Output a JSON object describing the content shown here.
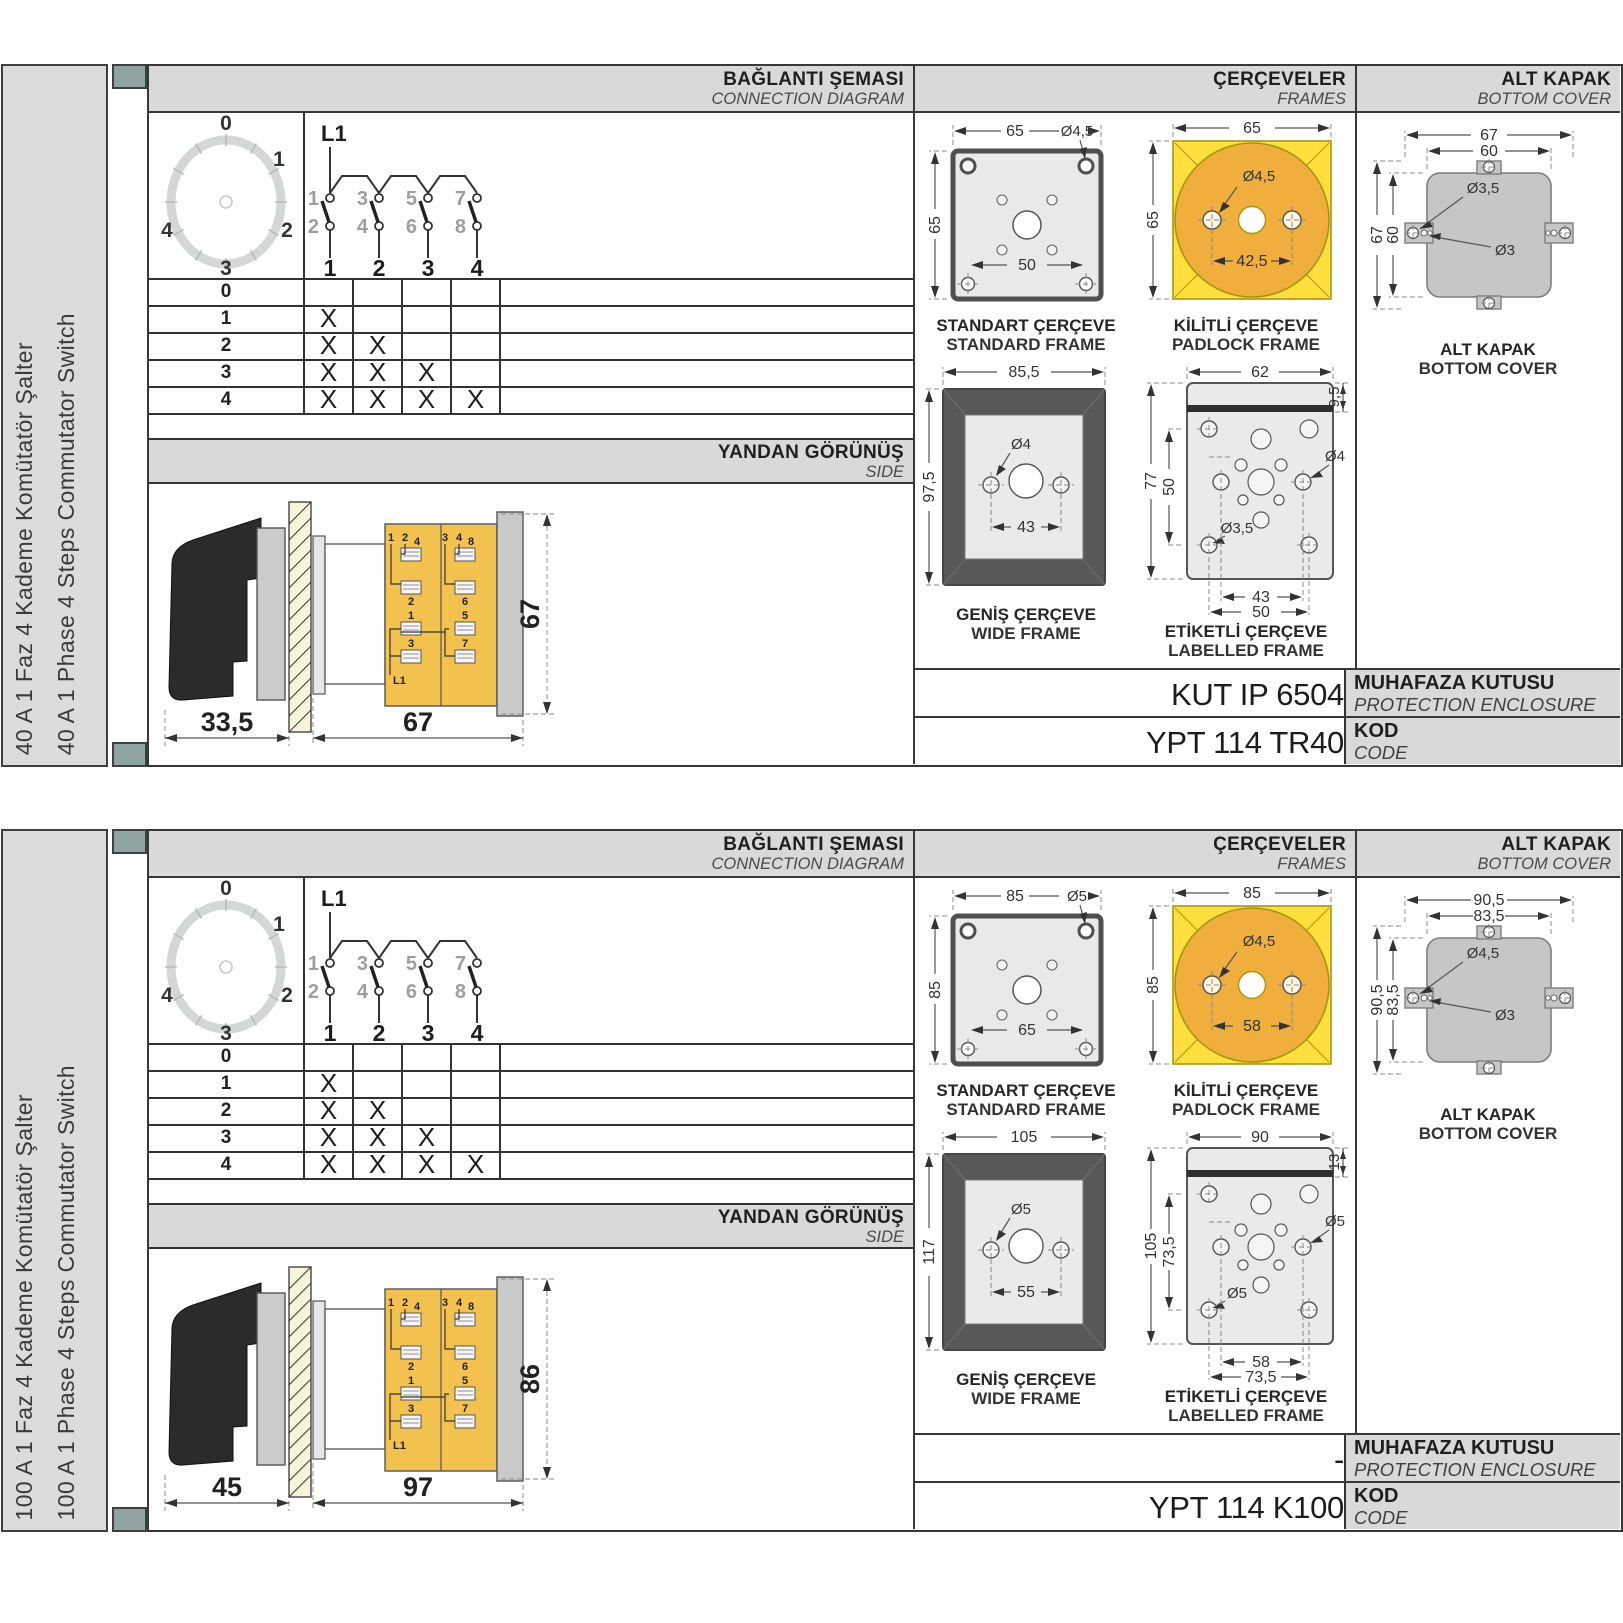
{
  "colors": {
    "header_bg": "#d9d9d9",
    "sidebar_bg": "#dcdcdc",
    "spine_square": "#8fa3a1",
    "frame_line": "#383838",
    "padlock_yellow": "#ffdf3e",
    "padlock_orange": "#f0ae3c",
    "switch_body_yellow": "#f2c14e",
    "wide_frame_gray": "#585858",
    "cover_gray": "#c6c6c6"
  },
  "sections": [
    {
      "sidebar": {
        "title_tr": "40 A 1 Faz 4 Kademe Komütatör Şalter",
        "title_en": "40 A 1 Phase 4 Steps Commutator Switch"
      },
      "headers": {
        "connection_tr": "BAĞLANTI ŞEMASI",
        "connection_en": "CONNECTION DIAGRAM",
        "frames_tr": "ÇERÇEVELER",
        "frames_en": "FRAMES",
        "cover_tr": "ALT KAPAK",
        "cover_en": "BOTTOM COVER"
      },
      "dial": {
        "positions": [
          "0",
          "1",
          "2",
          "3",
          "4"
        ]
      },
      "circuit": {
        "line": "L1",
        "top": [
          "1",
          "3",
          "5",
          "7"
        ],
        "bottom": [
          "2",
          "4",
          "6",
          "8"
        ],
        "outputs": [
          "1",
          "2",
          "3",
          "4"
        ]
      },
      "table": {
        "rows": [
          {
            "pos": "0",
            "marks": [
              "",
              "",
              "",
              ""
            ]
          },
          {
            "pos": "1",
            "marks": [
              "X",
              "",
              "",
              ""
            ]
          },
          {
            "pos": "2",
            "marks": [
              "X",
              "X",
              "",
              ""
            ]
          },
          {
            "pos": "3",
            "marks": [
              "X",
              "X",
              "X",
              ""
            ]
          },
          {
            "pos": "4",
            "marks": [
              "X",
              "X",
              "X",
              "X"
            ]
          }
        ]
      },
      "side": {
        "title_tr": "YANDAN GÖRÜNÜŞ",
        "title_en": "SIDE",
        "dim_handle": "33,5",
        "dim_depth": "67",
        "dim_height": "67",
        "terminals": {
          "pair_left": [
            "1",
            "2"
          ],
          "pair_right": [
            "3",
            "4"
          ],
          "left": [
            "4",
            "2",
            "1",
            "3"
          ],
          "right": [
            "8",
            "6",
            "5",
            "7"
          ],
          "line": "L1"
        }
      },
      "frames": {
        "standard": {
          "title_tr": "STANDART ÇERÇEVE",
          "title_en": "STANDARD FRAME",
          "dim_w": "65",
          "dim_h": "65",
          "dim_hole": "Ø4,5",
          "dim_pitch": "50"
        },
        "padlock": {
          "title_tr": "KİLİTLİ ÇERÇEVE",
          "title_en": "PADLOCK FRAME",
          "dim_w": "65",
          "dim_h": "65",
          "dim_hole": "Ø4,5",
          "dim_pitch": "42,5"
        },
        "wide": {
          "title_tr": "GENİŞ ÇERÇEVE",
          "title_en": "WIDE FRAME",
          "dim_w": "85,5",
          "dim_h": "97,5",
          "dim_hole": "Ø4",
          "dim_pitch": "43"
        },
        "labelled": {
          "title_tr": "ETİKETLİ ÇERÇEVE",
          "title_en": "LABELLED FRAME",
          "dim_w": "62",
          "dim_top": "9,5",
          "dim_h": "77",
          "dim_inner_h": "50",
          "dim_hole_r": "Ø4",
          "dim_hole_l": "Ø3,5",
          "dim_pitch1": "43",
          "dim_pitch2": "50"
        }
      },
      "cover": {
        "caption_tr": "ALT KAPAK",
        "caption_en": "BOTTOM COVER",
        "dim_w_outer": "67",
        "dim_w_inner": "60",
        "dim_h_outer": "67",
        "dim_h_inner": "60",
        "dim_hole1": "Ø3,5",
        "dim_hole2": "Ø3"
      },
      "codes": {
        "enclosure_value": "KUT IP 6504",
        "enclosure_label_tr": "MUHAFAZA KUTUSU",
        "enclosure_label_en": "PROTECTION ENCLOSURE",
        "code_value": "YPT 114 TR40",
        "code_label_tr": "KOD",
        "code_label_en": "CODE"
      }
    },
    {
      "sidebar": {
        "title_tr": "100 A 1 Faz 4 Kademe Komütatör Şalter",
        "title_en": "100 A 1 Phase 4 Steps Commutator Switch"
      },
      "headers": {
        "connection_tr": "BAĞLANTI ŞEMASI",
        "connection_en": "CONNECTION DIAGRAM",
        "frames_tr": "ÇERÇEVELER",
        "frames_en": "FRAMES",
        "cover_tr": "ALT KAPAK",
        "cover_en": "BOTTOM COVER"
      },
      "dial": {
        "positions": [
          "0",
          "1",
          "2",
          "3",
          "4"
        ]
      },
      "circuit": {
        "line": "L1",
        "top": [
          "1",
          "3",
          "5",
          "7"
        ],
        "bottom": [
          "2",
          "4",
          "6",
          "8"
        ],
        "outputs": [
          "1",
          "2",
          "3",
          "4"
        ]
      },
      "table": {
        "rows": [
          {
            "pos": "0",
            "marks": [
              "",
              "",
              "",
              ""
            ]
          },
          {
            "pos": "1",
            "marks": [
              "X",
              "",
              "",
              ""
            ]
          },
          {
            "pos": "2",
            "marks": [
              "X",
              "X",
              "",
              ""
            ]
          },
          {
            "pos": "3",
            "marks": [
              "X",
              "X",
              "X",
              ""
            ]
          },
          {
            "pos": "4",
            "marks": [
              "X",
              "X",
              "X",
              "X"
            ]
          }
        ]
      },
      "side": {
        "title_tr": "YANDAN GÖRÜNÜŞ",
        "title_en": "SIDE",
        "dim_handle": "45",
        "dim_depth": "97",
        "dim_height": "86",
        "terminals": {
          "pair_left": [
            "1",
            "2"
          ],
          "pair_right": [
            "3",
            "4"
          ],
          "left": [
            "4",
            "2",
            "1",
            "3"
          ],
          "right": [
            "8",
            "6",
            "5",
            "7"
          ],
          "line": "L1"
        }
      },
      "frames": {
        "standard": {
          "title_tr": "STANDART ÇERÇEVE",
          "title_en": "STANDARD FRAME",
          "dim_w": "85",
          "dim_h": "85",
          "dim_hole": "Ø5",
          "dim_pitch": "65"
        },
        "padlock": {
          "title_tr": "KİLİTLİ ÇERÇEVE",
          "title_en": "PADLOCK FRAME",
          "dim_w": "85",
          "dim_h": "85",
          "dim_hole": "Ø4,5",
          "dim_pitch": "58"
        },
        "wide": {
          "title_tr": "GENİŞ ÇERÇEVE",
          "title_en": "WIDE FRAME",
          "dim_w": "105",
          "dim_h": "117",
          "dim_hole": "Ø5",
          "dim_pitch": "55"
        },
        "labelled": {
          "title_tr": "ETİKETLİ ÇERÇEVE",
          "title_en": "LABELLED FRAME",
          "dim_w": "90",
          "dim_top": "13",
          "dim_h": "105",
          "dim_inner_h": "73,5",
          "dim_hole_r": "Ø5",
          "dim_hole_l": "Ø5",
          "dim_pitch1": "58",
          "dim_pitch2": "73,5"
        }
      },
      "cover": {
        "caption_tr": "ALT KAPAK",
        "caption_en": "BOTTOM COVER",
        "dim_w_outer": "90,5",
        "dim_w_inner": "83,5",
        "dim_h_outer": "90,5",
        "dim_h_inner": "83,5",
        "dim_hole1": "Ø4,5",
        "dim_hole2": "Ø3"
      },
      "codes": {
        "enclosure_value": "-",
        "enclosure_label_tr": "MUHAFAZA KUTUSU",
        "enclosure_label_en": "PROTECTION ENCLOSURE",
        "code_value": "YPT 114 K100",
        "code_label_tr": "KOD",
        "code_label_en": "CODE"
      }
    }
  ]
}
